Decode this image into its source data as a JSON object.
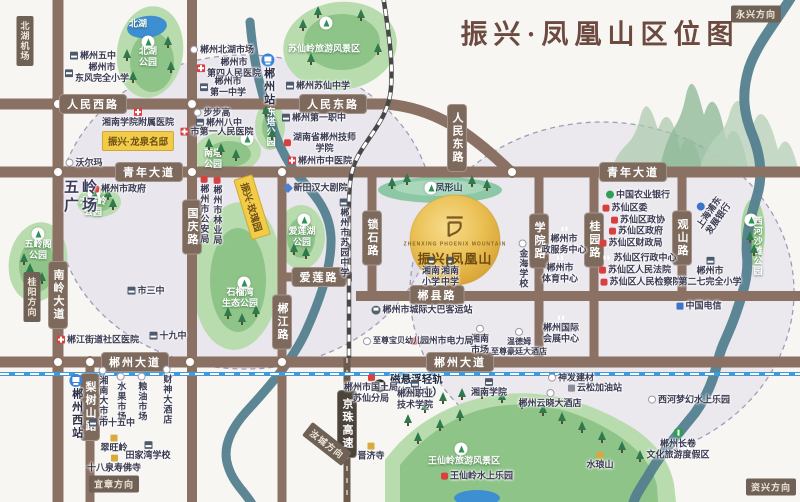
{
  "title": "振兴·凤凰山区位图",
  "project": {
    "name_cn": "振兴|凤凰山",
    "name_en": "ZHENXING PHOENIX MOUNTAIN"
  },
  "capsules": [
    {
      "t": "振兴·龙泉名邸",
      "x": 138,
      "y": 141
    },
    {
      "t": "振兴·玫瑰园",
      "x": 252,
      "y": 207,
      "rot": 73
    }
  ],
  "directions": [
    {
      "t": "北湖机场",
      "x": 25,
      "y": 41,
      "v": 1
    },
    {
      "t": "永兴方向",
      "x": 756,
      "y": 14
    },
    {
      "t": "桂阳方向",
      "x": 32,
      "y": 297,
      "v": 1
    },
    {
      "t": "宜章方向",
      "x": 114,
      "y": 484
    },
    {
      "t": "汝城方向",
      "x": 327,
      "y": 444,
      "rot": 38
    },
    {
      "t": "资兴方向",
      "x": 771,
      "y": 487
    }
  ],
  "road_labels": [
    {
      "t": "人民西路",
      "x": 93,
      "y": 104
    },
    {
      "t": "人民东路",
      "x": 333,
      "y": 104
    },
    {
      "t": "人民东路",
      "x": 457,
      "y": 138,
      "v": 1
    },
    {
      "t": "青年大道",
      "x": 149,
      "y": 172
    },
    {
      "t": "青年大道",
      "x": 633,
      "y": 172
    },
    {
      "t": "国庆路",
      "x": 192,
      "y": 227,
      "v": 1
    },
    {
      "t": "南岭大道",
      "x": 58,
      "y": 295,
      "v": 1
    },
    {
      "t": "郴江路",
      "x": 282,
      "y": 322,
      "v": 1
    },
    {
      "t": "锁石路",
      "x": 372,
      "y": 238,
      "v": 1
    },
    {
      "t": "学院路",
      "x": 539,
      "y": 241,
      "v": 1
    },
    {
      "t": "桂园路",
      "x": 594,
      "y": 240,
      "v": 1
    },
    {
      "t": "观山路",
      "x": 682,
      "y": 238,
      "v": 1
    },
    {
      "t": "梨树山路",
      "x": 90,
      "y": 407,
      "v": 1
    },
    {
      "t": "爱莲路",
      "x": 319,
      "y": 277
    },
    {
      "t": "郴县路",
      "x": 437,
      "y": 295
    },
    {
      "t": "郴州大道",
      "x": 135,
      "y": 362
    },
    {
      "t": "郴州大道",
      "x": 460,
      "y": 362
    },
    {
      "t": "京珠高速",
      "x": 347,
      "y": 424,
      "v": 1,
      "dark": 1
    }
  ],
  "park_labels": [
    {
      "t": [
        "北湖"
      ],
      "x": 138,
      "y": 24
    },
    {
      "t": [
        "北湖",
        "公园"
      ],
      "x": 148,
      "y": 57,
      "bx": 148,
      "by": 42
    },
    {
      "t": [
        "苏仙岭旅游风景区"
      ],
      "x": 324,
      "y": 49,
      "bx": 326,
      "by": 23
    },
    {
      "t": [
        "南塔",
        "公园"
      ],
      "x": 213,
      "y": 159,
      "bx": 247,
      "by": 139
    },
    {
      "t": [
        "东塔公园"
      ],
      "x": 270,
      "y": 127,
      "v": 1
    },
    {
      "t": [
        "木子岭",
        "公园"
      ],
      "x": 93,
      "y": 207,
      "bx": 94,
      "by": 193
    },
    {
      "t": [
        "五岭阁",
        "公园"
      ],
      "x": 38,
      "y": 250,
      "bx": 38,
      "by": 234
    },
    {
      "t": [
        "石榴湾",
        "生态公园"
      ],
      "x": 240,
      "y": 298,
      "bx": 244,
      "by": 283
    },
    {
      "t": [
        "爱莲湖",
        "公园"
      ],
      "x": 302,
      "y": 237,
      "bx": 304,
      "by": 220
    },
    {
      "t": [
        "西河沙滩公园"
      ],
      "x": 757,
      "y": 246,
      "v": 1,
      "bx": 751,
      "by": 220
    },
    {
      "t": [
        "王仙岭旅游风景区"
      ],
      "x": 464,
      "y": 461,
      "bx": 461,
      "by": 449
    },
    {
      "t": [
        "凤形山"
      ],
      "x": 449,
      "y": 188,
      "dark": 1,
      "bx": 431,
      "by": 188
    }
  ],
  "pois": [
    {
      "n": "chenzhou-no5-school",
      "t": [
        "郴州五中"
      ],
      "x": 93,
      "y": 56,
      "ic": "s"
    },
    {
      "n": "dongfeng-primary-school",
      "t": [
        "郴州市",
        "东风完全小学"
      ],
      "x": 97,
      "y": 73,
      "ic": "s"
    },
    {
      "n": "beihu-market",
      "t": [
        "郴州北湖市场"
      ],
      "x": 222,
      "y": 50,
      "ic": "c"
    },
    {
      "n": "fourth-peoples-hospital",
      "t": [
        "郴州市",
        "第四人民医院"
      ],
      "x": 229,
      "y": 68,
      "ic": "h"
    },
    {
      "n": "no1-middle-school",
      "t": [
        "郴州市",
        "第一中学"
      ],
      "x": 223,
      "y": 87,
      "ic": "s"
    },
    {
      "n": "xiangnan-affiliated-hospital",
      "t": [
        "湘南学院附属医院"
      ],
      "x": 138,
      "y": 118,
      "ic": "h",
      "col": 1
    },
    {
      "n": "walmart",
      "t": [
        "沃尔玛"
      ],
      "x": 84,
      "y": 163,
      "ic": "c"
    },
    {
      "n": "bubugao",
      "t": [
        "步步高"
      ],
      "x": 212,
      "y": 113,
      "ic": "c"
    },
    {
      "n": "no8-middle-school",
      "t": [
        "郴州八中"
      ],
      "x": 219,
      "y": 123,
      "ic": "s"
    },
    {
      "n": "first-peoples-hospital",
      "t": [
        "市第一人民医院"
      ],
      "x": 217,
      "y": 132,
      "ic": "h"
    },
    {
      "n": "suxian-middle-school",
      "t": [
        "郴州苏仙中学"
      ],
      "x": 318,
      "y": 86,
      "ic": "s"
    },
    {
      "n": "first-vocational-school",
      "t": [
        "郴州第一职中"
      ],
      "x": 314,
      "y": 118,
      "ic": "s"
    },
    {
      "n": "technician-college",
      "t": [
        "湖南省郴州技师",
        "学院"
      ],
      "x": 320,
      "y": 143,
      "ic": "g"
    },
    {
      "n": "tcm-hospital",
      "t": [
        "郴州市中医院"
      ],
      "x": 320,
      "y": 161,
      "ic": "h"
    },
    {
      "n": "chenzhou-station",
      "t": [
        "郴州站"
      ],
      "x": 268,
      "y": 80,
      "ic": "tr",
      "v": 1,
      "cls": "station"
    },
    {
      "n": "city-government",
      "t": [
        "郴州市政府"
      ],
      "x": 119,
      "y": 189,
      "ic": "g"
    },
    {
      "n": "wuling-square",
      "t": [
        "五岭",
        "广场"
      ],
      "x": 82,
      "y": 197,
      "cls": "big"
    },
    {
      "n": "public-security-bureau",
      "t": [
        "郴州市公安局"
      ],
      "x": 204,
      "y": 210,
      "ic": "g",
      "v": 1
    },
    {
      "n": "forestry-bureau",
      "t": [
        "郴州市林业局"
      ],
      "x": 217,
      "y": 211,
      "ic": "g",
      "v": 1
    },
    {
      "n": "no3-middle-school",
      "t": [
        "市三中"
      ],
      "x": 146,
      "y": 291,
      "ic": "s"
    },
    {
      "n": "no19-middle-school",
      "t": [
        "十九中"
      ],
      "x": 168,
      "y": 336,
      "ic": "s"
    },
    {
      "n": "chenjiang-community-hospital",
      "t": [
        "郴江街道社区医院"
      ],
      "x": 98,
      "y": 340,
      "ic": "h"
    },
    {
      "n": "xintianhan-theater",
      "t": [
        "新田汉大剧院"
      ],
      "x": 316,
      "y": 188,
      "ic": "th"
    },
    {
      "n": "suyuan-middle-school",
      "t": [
        "郴州市苏园中学"
      ],
      "x": 344,
      "y": 238,
      "ic": "s",
      "v": 1
    },
    {
      "n": "xiangnan-primary-school",
      "t": [
        "湘南",
        "小学"
      ],
      "x": 431,
      "y": 272,
      "ic": "s",
      "col": 1
    },
    {
      "n": "xiangnan-middle-school",
      "t": [
        "湘南",
        "中学"
      ],
      "x": 450,
      "y": 272,
      "ic": "s",
      "col": 1
    },
    {
      "n": "intercity-bus-station",
      "t": [
        "郴州市城际大巴客运站"
      ],
      "x": 422,
      "y": 310,
      "ic": "bus"
    },
    {
      "n": "jinhai-school",
      "t": [
        "金海学校"
      ],
      "x": 523,
      "y": 264,
      "ic": "c",
      "v": 1
    },
    {
      "n": "municipal-service-center",
      "t": [
        "郴州市",
        "政服务中心"
      ],
      "x": 564,
      "y": 240,
      "ic": "b",
      "col": 1
    },
    {
      "n": "sports-center",
      "t": [
        "郴州市",
        "体育中心"
      ],
      "x": 560,
      "y": 269,
      "ic": "b",
      "col": 1
    },
    {
      "n": "convention-center",
      "t": [
        "郴州国际",
        "会展中心"
      ],
      "x": 561,
      "y": 329,
      "ic": "b",
      "col": 1
    },
    {
      "n": "agricultural-bank",
      "t": [
        "中国农业银行"
      ],
      "x": 638,
      "y": 195,
      "ic": "bg"
    },
    {
      "n": "suxian-committee",
      "t": [
        "苏仙区委"
      ],
      "x": 625,
      "y": 208,
      "ic": "g"
    },
    {
      "n": "suxian-cppcc",
      "t": [
        "苏仙区政协"
      ],
      "x": 638,
      "y": 220,
      "ic": "g"
    },
    {
      "n": "suxian-government",
      "t": [
        "苏仙区政府"
      ],
      "x": 636,
      "y": 231,
      "ic": "g"
    },
    {
      "n": "suxian-finance-bureau",
      "t": [
        "苏仙区财政局"
      ],
      "x": 631,
      "y": 243,
      "ic": "g"
    },
    {
      "n": "suxian-admin-center",
      "t": [
        "苏仙区行政中心"
      ],
      "x": 639,
      "y": 258,
      "ic": "b"
    },
    {
      "n": "suxian-court",
      "t": [
        "苏仙区人民法院"
      ],
      "x": 635,
      "y": 270,
      "ic": "g"
    },
    {
      "n": "suxian-procuratorate",
      "t": [
        "苏仙区人民检察院"
      ],
      "x": 641,
      "y": 282,
      "ic": "g"
    },
    {
      "n": "spd-bank",
      "t": [
        "上海浦东",
        "发展银行"
      ],
      "x": 710,
      "y": 213,
      "ic": "bb",
      "col": 1,
      "rot": -55
    },
    {
      "n": "no27-primary-school",
      "t": [
        "郴州市",
        "第二七完全小学"
      ],
      "x": 710,
      "y": 272,
      "ic": "s",
      "col": 1
    },
    {
      "n": "china-telecom",
      "t": [
        "中国电信"
      ],
      "x": 699,
      "y": 306,
      "ic": "tel"
    },
    {
      "n": "chenzhou-west-station",
      "t": [
        "郴州西站"
      ],
      "x": 76,
      "y": 407,
      "ic": "tr",
      "v": 1,
      "cls": "station"
    },
    {
      "n": "xiangnan-big-market",
      "t": [
        "湘南大市场"
      ],
      "x": 103,
      "y": 396,
      "ic": "c",
      "v": 1
    },
    {
      "n": "fruit-market",
      "t": [
        "水果市场"
      ],
      "x": 121,
      "y": 397,
      "ic": "c",
      "v": 1
    },
    {
      "n": "grain-oil-market",
      "t": [
        "粮油市场"
      ],
      "x": 142,
      "y": 397,
      "ic": "c",
      "v": 1
    },
    {
      "n": "caishen-hotel",
      "t": [
        "财神大酒店"
      ],
      "x": 167,
      "y": 395,
      "ic": "c",
      "v": 1
    },
    {
      "n": "no15-middle-school",
      "t": [
        "市十五中"
      ],
      "x": 112,
      "y": 423,
      "ic": "s"
    },
    {
      "n": "cuiwangling",
      "t": [
        "翠旺岭"
      ],
      "x": 114,
      "y": 444,
      "ic": "t",
      "col": 1
    },
    {
      "n": "tianjiawan-school",
      "t": [
        "田家湾学校"
      ],
      "x": 148,
      "y": 451,
      "ic": "s",
      "col": 1
    },
    {
      "n": "shibaquan-shoufo-temple",
      "t": [
        "十八泉寿佛寺"
      ],
      "x": 114,
      "y": 464,
      "ic": "t",
      "col": 1
    },
    {
      "n": "maglev-label",
      "t": [
        "磁悬浮轻轨",
        "（规划中）"
      ],
      "x": 408,
      "y": 386,
      "ic": "trb",
      "cls": "maglev"
    },
    {
      "n": "land-bureau-suxian-branch",
      "t": [
        "郴州市国土局",
        "苏仙分局"
      ],
      "x": 371,
      "y": 389,
      "ic": "g",
      "col": 1
    },
    {
      "n": "vocational-tech-college",
      "t": [
        "郴州职业",
        "技术学院"
      ],
      "x": 415,
      "y": 395,
      "ic": "s",
      "col": 1
    },
    {
      "n": "xiangnan-university",
      "t": [
        "湘南学院"
      ],
      "x": 489,
      "y": 388,
      "ic": "s",
      "col": 1
    },
    {
      "n": "shenfa-building-materials",
      "t": [
        "神发建材"
      ],
      "x": 571,
      "y": 378,
      "ic": "c"
    },
    {
      "n": "yunsong-gas-station",
      "t": [
        "云松加油站"
      ],
      "x": 595,
      "y": 388,
      "ic": "gas"
    },
    {
      "n": "yunxiao-hotel",
      "t": [
        "郴州云晓大酒店"
      ],
      "x": 550,
      "y": 399,
      "ic": "c",
      "col": 1
    },
    {
      "n": "wyndham-hotel",
      "t": [
        "温德姆",
        "至尊豪廷大酒店"
      ],
      "x": 519,
      "y": 342,
      "ic": "c",
      "col": 1,
      "cls": "tiny"
    },
    {
      "n": "xiangnan-market",
      "t": [
        "湘南",
        "市场"
      ],
      "x": 480,
      "y": 340,
      "ic": "c",
      "col": 1
    },
    {
      "n": "power-bureau",
      "t": [
        "郴州市电力局"
      ],
      "x": 442,
      "y": 341,
      "ic": "g"
    },
    {
      "n": "zhizun-baby-kindergarten",
      "t": [
        "至尊宝贝幼儿园"
      ],
      "x": 396,
      "y": 341,
      "ic": "c",
      "cls": "tiny"
    },
    {
      "n": "jinji-temple",
      "t": [
        "晋济寺"
      ],
      "x": 371,
      "y": 452,
      "ic": "t",
      "col": 1
    },
    {
      "n": "xihe-dream-water-park",
      "t": [
        "西河梦幻水上乐园"
      ],
      "x": 689,
      "y": 400,
      "ic": "c"
    },
    {
      "n": "changjuan-resort",
      "t": [
        "郴州长卷",
        "文化旅游度假区"
      ],
      "x": 678,
      "y": 444,
      "ic": "tg",
      "col": 1
    },
    {
      "n": "shuilangshan",
      "t": [
        "水琅山"
      ],
      "x": 600,
      "y": 461,
      "ic": "t",
      "col": 1
    },
    {
      "n": "wangxianling-water-park",
      "t": [
        "王仙岭水上乐园"
      ],
      "x": 477,
      "y": 476,
      "ic": "g"
    }
  ],
  "decor": {
    "junctions": [
      [
        58,
        104
      ],
      [
        192,
        104
      ],
      [
        58,
        172
      ],
      [
        192,
        172
      ],
      [
        282,
        172
      ],
      [
        512,
        172
      ],
      [
        58,
        362
      ],
      [
        90,
        362
      ],
      [
        190,
        362
      ],
      [
        282,
        362
      ]
    ],
    "trees": [
      [
        127,
        58
      ],
      [
        133,
        80
      ],
      [
        168,
        45
      ],
      [
        171,
        70
      ],
      [
        303,
        28
      ],
      [
        318,
        15
      ],
      [
        361,
        18
      ],
      [
        378,
        52
      ],
      [
        311,
        62
      ],
      [
        221,
        152
      ],
      [
        236,
        158
      ],
      [
        209,
        147
      ],
      [
        266,
        114
      ],
      [
        272,
        137
      ],
      [
        108,
        197
      ],
      [
        113,
        207
      ],
      [
        30,
        272
      ],
      [
        42,
        281
      ],
      [
        24,
        262
      ],
      [
        228,
        316
      ],
      [
        242,
        322
      ],
      [
        256,
        314
      ],
      [
        294,
        252
      ],
      [
        306,
        256
      ],
      [
        392,
        186
      ],
      [
        407,
        182
      ],
      [
        472,
        184
      ],
      [
        487,
        188
      ],
      [
        750,
        240
      ],
      [
        754,
        253
      ],
      [
        408,
        423
      ],
      [
        425,
        410
      ],
      [
        443,
        401
      ],
      [
        462,
        397
      ],
      [
        482,
        396
      ],
      [
        502,
        400
      ],
      [
        522,
        406
      ],
      [
        543,
        413
      ],
      [
        562,
        421
      ],
      [
        582,
        430
      ],
      [
        602,
        440
      ],
      [
        622,
        450
      ],
      [
        640,
        459
      ],
      [
        418,
        441
      ],
      [
        440,
        428
      ],
      [
        460,
        418
      ]
    ]
  }
}
